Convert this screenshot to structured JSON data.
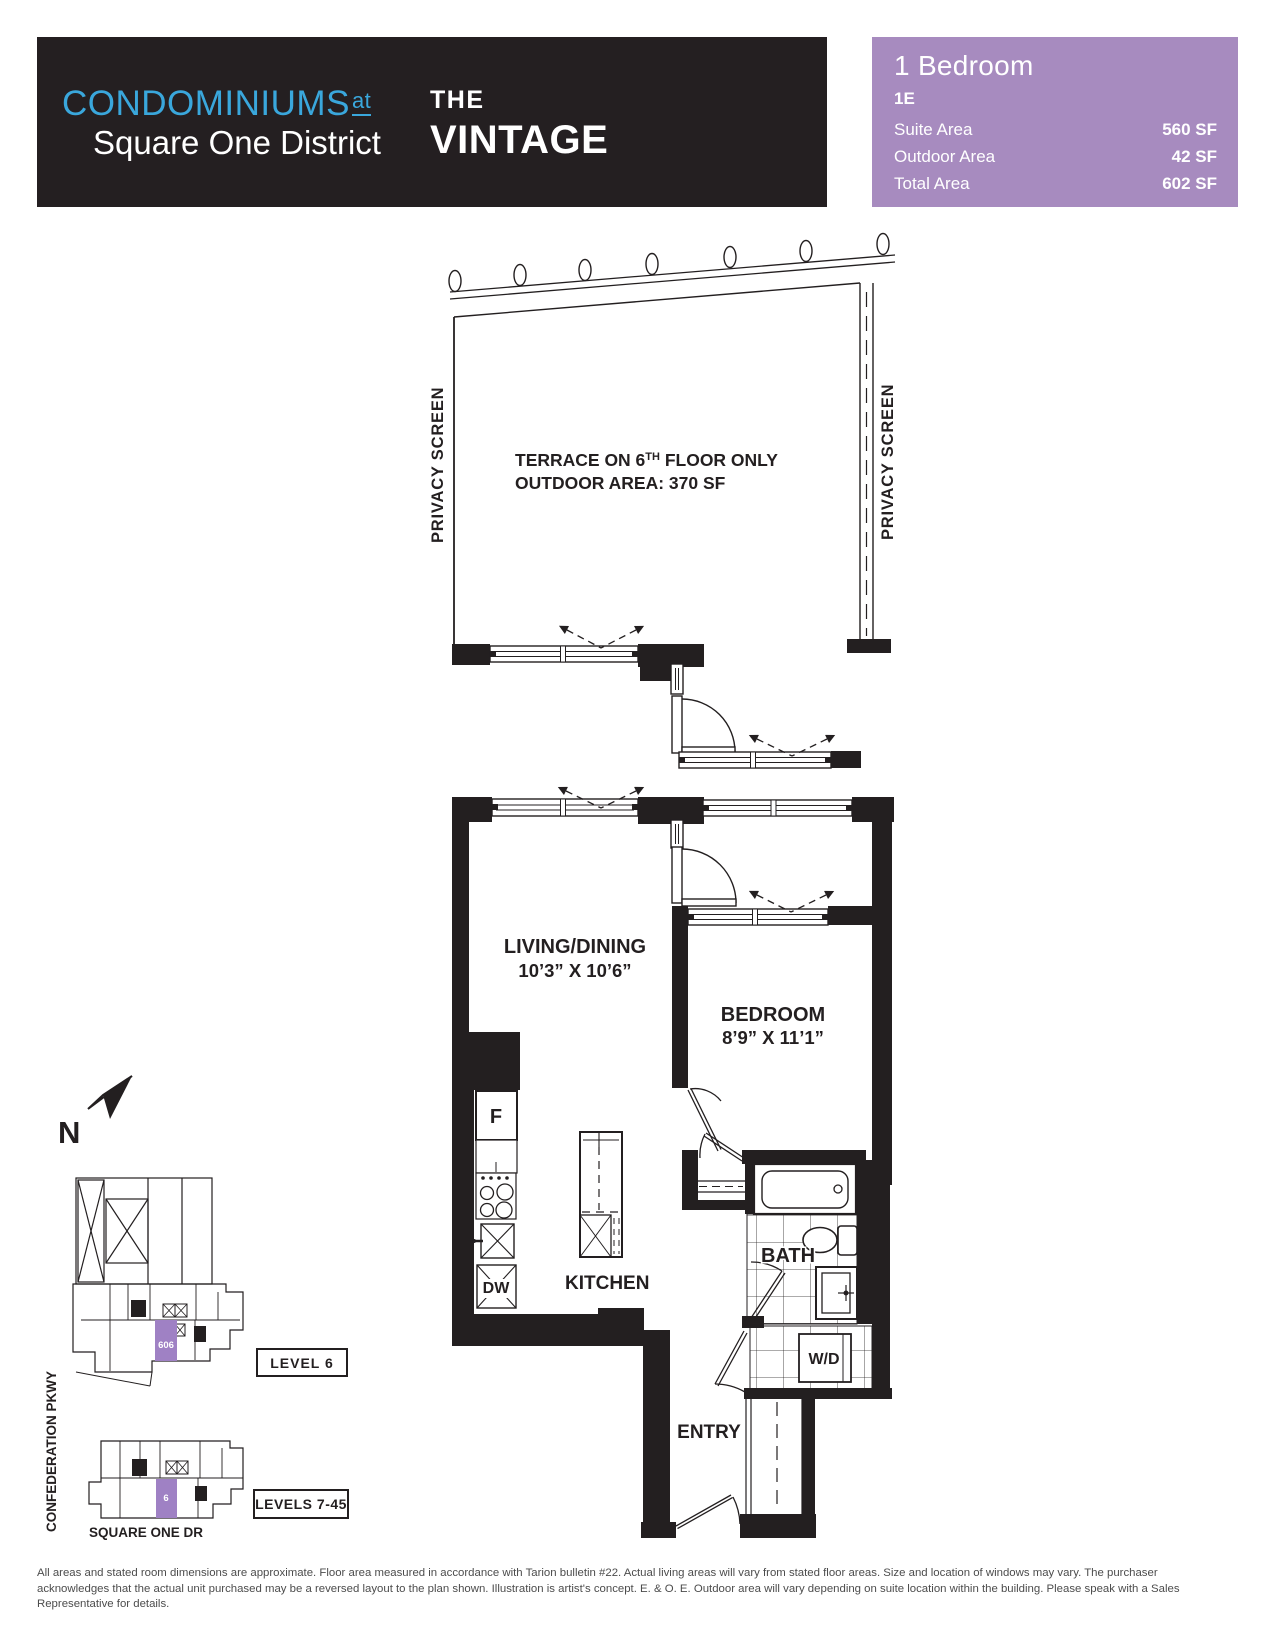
{
  "header": {
    "logo": {
      "line1": "CONDOMINIUMS",
      "line1_suffix": "at",
      "line2": "Square One District"
    },
    "building": {
      "pre": "THE",
      "name": "VINTAGE"
    }
  },
  "info_panel": {
    "unit_type": "1 Bedroom",
    "unit_code": "1E",
    "rows": [
      {
        "label": "Suite Area",
        "value": "560 SF"
      },
      {
        "label": "Outdoor Area",
        "value": "42 SF"
      },
      {
        "label": "Total Area",
        "value": "602 SF"
      }
    ]
  },
  "plan": {
    "terrace": {
      "line1_pre": "TERRACE ON 6",
      "line1_sup": "TH",
      "line1_post": " FLOOR ONLY",
      "line2": "OUTDOOR AREA: 370 SF"
    },
    "privacy_screen_left": "PRIVACY SCREEN",
    "privacy_screen_right": "PRIVACY SCREEN",
    "rooms": {
      "living": {
        "name": "LIVING/DINING",
        "dims": "10’3” X 10’6”"
      },
      "bedroom": {
        "name": "BEDROOM",
        "dims": "8’9” X 11’1”"
      },
      "kitchen": {
        "name": "KITCHEN"
      },
      "bath": {
        "name": "BATH"
      },
      "entry": {
        "name": "ENTRY"
      }
    },
    "appliances": {
      "fridge": "F",
      "dishwasher": "DW",
      "washer_dryer": "W/D"
    }
  },
  "keyplans": {
    "north_label": "N",
    "level6": {
      "label": "LEVEL 6",
      "unit": "606"
    },
    "levels7_45": {
      "label": "LEVELS 7-45",
      "unit": "6"
    },
    "streets": {
      "west": "CONFEDERATION PKWY",
      "south": "SQUARE ONE DR"
    }
  },
  "disclaimer": {
    "lines": [
      "All areas and stated room dimensions are approximate. Floor area measured in accordance with Tarion bulletin #22. Actual living areas will vary from stated floor areas. Size and location of windows may vary. The purchaser",
      "acknowledges that the actual unit purchased may be a reversed layout to the plan shown. Illustration is artist's concept. E. & O. E. Outdoor area will vary depending on suite location within the building. Please speak with a Sales",
      "Representative for details."
    ]
  },
  "colors": {
    "logo_blue": "#3aa7dc",
    "panel_purple": "#a78bbf",
    "keyplan_unit_purple": "#9f81c4",
    "ink": "#231f20",
    "disclaimer_gray": "#4c4c4c"
  }
}
